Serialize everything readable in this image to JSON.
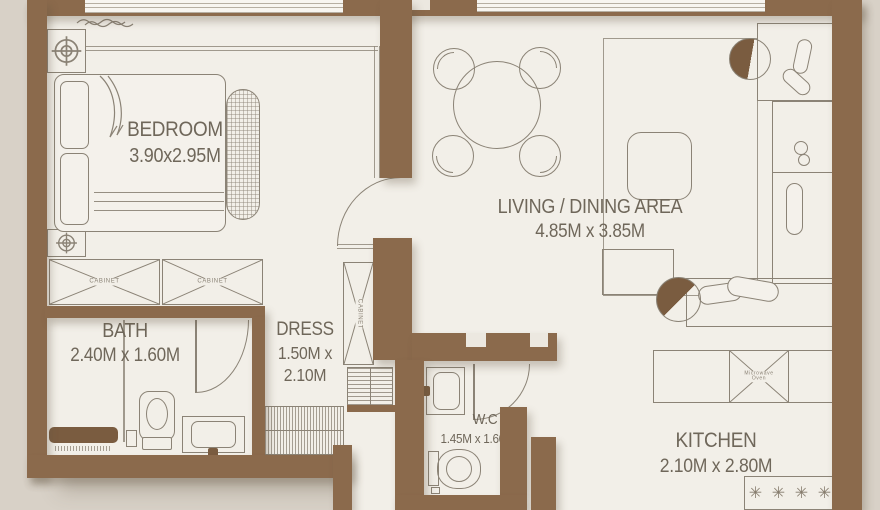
{
  "title": "Apartment Floor Plan",
  "colors": {
    "wall": "#8b6a4c",
    "floor": "#f2efe8",
    "background": "#d8d1c7",
    "line": "#8b8376",
    "text": "#6f675a",
    "fixture_dark": "#7a5c40"
  },
  "rooms": {
    "bedroom": {
      "name": "BEDROOM",
      "dims": "3.90x2.95M"
    },
    "living": {
      "name": "LIVING / DINING AREA",
      "dims": "4.85M x 3.85M"
    },
    "bath": {
      "name": "BATH",
      "dims": "2.40M x 1.60M"
    },
    "dress": {
      "name": "DRESS",
      "dims_line1": "1.50M x",
      "dims_line2": "2.10M"
    },
    "wc": {
      "name": "W.C",
      "dims": "1.45M x 1.60M"
    },
    "kitchen": {
      "name": "KITCHEN",
      "dims": "2.10M x 2.80M"
    }
  },
  "fixtures": {
    "cabinet_left": "CABINET",
    "cabinet_right": "CABINET",
    "cabinet_dress": "CABINET",
    "microwave": "Microwave Oven"
  },
  "icons": {
    "burner": "✳"
  }
}
